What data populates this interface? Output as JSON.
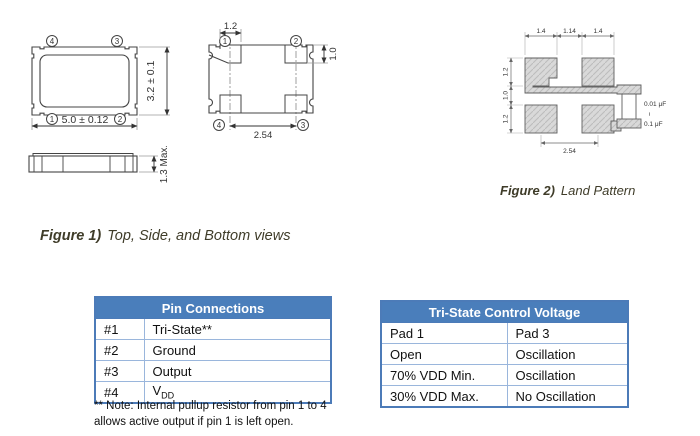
{
  "figure1": {
    "caption_label": "Figure 1)",
    "caption_text": "Top, Side, and Bottom views",
    "top_view": {
      "pin_top_left": "4",
      "pin_top_right": "3",
      "pin_bottom_left": "1",
      "pin_bottom_right": "2",
      "width_dim": "5.0 ± 0.12",
      "height_dim": "3.2 ± 0.1"
    },
    "side_view": {
      "height_dim": "1.3 Max."
    },
    "bottom_view": {
      "pin_top_left": "1",
      "pin_top_right": "2",
      "pin_bottom_left": "4",
      "pin_bottom_right": "3",
      "pad_width_dim": "1.2",
      "pad_height_dim": "1.0",
      "pitch_dim": "2.54"
    }
  },
  "figure2": {
    "caption_label": "Figure 2)",
    "caption_text": "Land Pattern",
    "dims": {
      "top_left_pad_w": "1.4",
      "top_gap": "1.14",
      "top_right_pad_w": "1.4",
      "left_top_pad_h": "1.2",
      "left_gap": "1.0",
      "left_bottom_pad_h": "1.2",
      "bottom_pitch": "2.54"
    },
    "capacitor": {
      "min": "0.01 μF",
      "range_symbol": "~",
      "max": "0.1 μF"
    }
  },
  "pin_table": {
    "title": "Pin Connections",
    "rows": [
      {
        "pin": "#1",
        "function": "Tri-State**"
      },
      {
        "pin": "#2",
        "function": "Ground"
      },
      {
        "pin": "#3",
        "function": "Output"
      },
      {
        "pin": "#4",
        "function": "V",
        "function_sub": "DD"
      }
    ],
    "note_line1": "** Note: Internal pullup resistor from pin 1 to 4",
    "note_line2": "allows active output if pin 1 is left open."
  },
  "tristate_table": {
    "title": "Tri-State Control Voltage",
    "rows": [
      {
        "col1": "Pad 1",
        "col2": "Pad 3"
      },
      {
        "col1": "Open",
        "col2": "Oscillation"
      },
      {
        "col1": "70% VDD Min.",
        "col2": "Oscillation"
      },
      {
        "col1": "30% VDD Max.",
        "col2": "No Oscillation"
      }
    ]
  },
  "colors": {
    "table_header_bg": "#4a7ebb",
    "table_border": "#4c7bb8",
    "table_inner_border": "#9ab6dc",
    "caption_color": "#3f3c29",
    "drawing_line": "#444444",
    "pad_fill": "#d9d9d9"
  }
}
